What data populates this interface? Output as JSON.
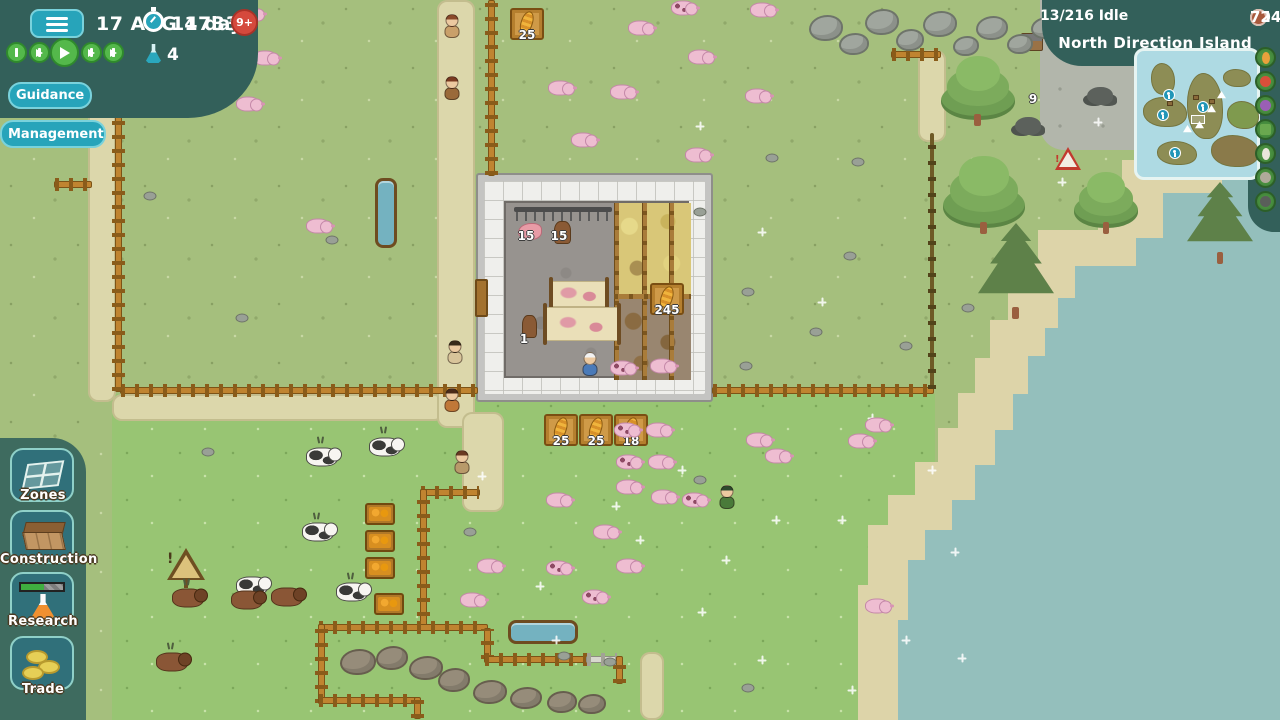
{
  "hud": {
    "date": "17 AUG 1733",
    "timer_label": "14 days",
    "age_badge": "9+",
    "research_points": "4",
    "controls": [
      "pause",
      "slow",
      "play",
      "fast",
      "fastest"
    ],
    "guidance_label": "Guidance",
    "management_label": "Management"
  },
  "topbar_right": {
    "idle_label": "13/216 Idle",
    "resources": [
      {
        "name": "wood",
        "value": "124",
        "color": "#d9b268"
      },
      {
        "name": "stone",
        "value": "80",
        "color": "#c3c8bf"
      },
      {
        "name": "food",
        "value": "95",
        "color": "#58b14c"
      },
      {
        "name": "bricks",
        "value": "72",
        "color": "#a8593c"
      }
    ],
    "location": "North Direction Island"
  },
  "minimap": {
    "islands": [
      {
        "x": 14,
        "y": 12,
        "w": 24,
        "h": 32
      },
      {
        "x": 6,
        "y": 46,
        "w": 44,
        "h": 30
      },
      {
        "x": 50,
        "y": 22,
        "w": 36,
        "h": 66
      },
      {
        "x": 86,
        "y": 18,
        "w": 28,
        "h": 18
      },
      {
        "x": 90,
        "y": 50,
        "w": 32,
        "h": 28,
        "c": "#7f9a4e"
      },
      {
        "x": 20,
        "y": 90,
        "w": 40,
        "h": 24
      },
      {
        "x": 74,
        "y": 84,
        "w": 48,
        "h": 32,
        "c": "#8a7a4a"
      }
    ],
    "anchors": [
      {
        "x": 26,
        "y": 38
      },
      {
        "x": 20,
        "y": 58
      },
      {
        "x": 60,
        "y": 50
      },
      {
        "x": 32,
        "y": 96
      }
    ],
    "ships": [
      {
        "x": 70,
        "y": 54
      },
      {
        "x": 58,
        "y": 70
      },
      {
        "x": 46,
        "y": 74
      },
      {
        "x": 80,
        "y": 40
      }
    ],
    "huts": [
      {
        "x": 30,
        "y": 50
      },
      {
        "x": 72,
        "y": 48
      },
      {
        "x": 56,
        "y": 44
      }
    ],
    "outline_rect": {
      "x": 54,
      "y": 64,
      "w": 14,
      "h": 9
    }
  },
  "map_filters": [
    {
      "name": "corn",
      "color": "#e8a13c"
    },
    {
      "name": "tomato",
      "color": "#d84f3a"
    },
    {
      "name": "grapes",
      "color": "#9a5fb5"
    },
    {
      "name": "crate",
      "color": "#6aa84f"
    },
    {
      "name": "egg",
      "color": "#eae6da"
    },
    {
      "name": "stone",
      "color": "#b0aa9a"
    },
    {
      "name": "coal",
      "color": "#5a5f5a"
    }
  ],
  "sidebar": {
    "items": [
      {
        "id": "zones",
        "label": "Zones"
      },
      {
        "id": "construction",
        "label": "Construction"
      },
      {
        "id": "research",
        "label": "Research"
      },
      {
        "id": "trade",
        "label": "Trade"
      }
    ]
  },
  "world": {
    "colors": {
      "grass": "#a5bf7d",
      "pasture": "#98c573",
      "sand": "#ddd4a9",
      "water": "#94bfbc",
      "path": "#dcd7ab",
      "hudteal": "#33605a",
      "btn_teal": "#27a4ba"
    },
    "items": [
      {
        "t": "path",
        "x": 88,
        "y": 0,
        "w": 28,
        "h": 402
      },
      {
        "t": "path",
        "x": 112,
        "y": 394,
        "w": 332,
        "h": 27
      },
      {
        "t": "path",
        "x": 437,
        "y": 0,
        "w": 38,
        "h": 428
      },
      {
        "t": "path",
        "x": 462,
        "y": 412,
        "w": 42,
        "h": 100
      },
      {
        "t": "path",
        "x": 918,
        "y": 50,
        "w": 28,
        "h": 92
      },
      {
        "t": "path",
        "x": 640,
        "y": 652,
        "w": 24,
        "h": 68
      },
      {
        "t": "fh",
        "x": 120,
        "y": 387,
        "l": 358
      },
      {
        "t": "fh",
        "x": 712,
        "y": 387,
        "l": 222
      },
      {
        "t": "fp",
        "x": 930,
        "y": 133,
        "l": 256
      },
      {
        "t": "fv",
        "x": 115,
        "y": 0,
        "l": 392
      },
      {
        "t": "fv",
        "x": 488,
        "y": 0,
        "l": 176
      },
      {
        "t": "fh",
        "x": 54,
        "y": 181,
        "l": 38
      },
      {
        "t": "fv",
        "x": 179,
        "y": 0,
        "l": 88
      },
      {
        "t": "fh",
        "x": 891,
        "y": 51,
        "l": 50
      },
      {
        "t": "fh",
        "x": 420,
        "y": 489,
        "l": 60
      },
      {
        "t": "fv",
        "x": 420,
        "y": 489,
        "l": 142
      },
      {
        "t": "fh",
        "x": 318,
        "y": 624,
        "l": 170
      },
      {
        "t": "fv",
        "x": 484,
        "y": 628,
        "l": 32
      },
      {
        "t": "fh",
        "x": 484,
        "y": 656,
        "l": 104
      },
      {
        "t": "fhw",
        "x": 586,
        "y": 656,
        "l": 32
      },
      {
        "t": "fv",
        "x": 616,
        "y": 656,
        "l": 28
      },
      {
        "t": "fv",
        "x": 318,
        "y": 624,
        "l": 80
      },
      {
        "t": "fh",
        "x": 318,
        "y": 697,
        "l": 100
      },
      {
        "t": "fv",
        "x": 414,
        "y": 697,
        "l": 22
      },
      {
        "t": "trv",
        "x": 375,
        "y": 178,
        "w": 22,
        "h": 70
      },
      {
        "t": "trh",
        "x": 508,
        "y": 620,
        "w": 70,
        "h": 24
      },
      {
        "t": "crate",
        "x": 527,
        "y": 24,
        "v": "25"
      },
      {
        "t": "crate",
        "x": 561,
        "y": 430,
        "v": "25"
      },
      {
        "t": "crate",
        "x": 596,
        "y": 430,
        "v": "25"
      },
      {
        "t": "crate",
        "x": 631,
        "y": 430,
        "v": "18"
      },
      {
        "t": "crate",
        "x": 667,
        "y": 299,
        "v": "245"
      },
      {
        "t": "amber",
        "x": 380,
        "y": 514
      },
      {
        "t": "amber",
        "x": 380,
        "y": 541
      },
      {
        "t": "amber",
        "x": 380,
        "y": 568
      },
      {
        "t": "amber",
        "x": 389,
        "y": 604
      },
      {
        "t": "signw",
        "x": 186,
        "y": 566
      },
      {
        "t": "signr",
        "x": 1068,
        "y": 160
      },
      {
        "t": "hut",
        "x": 1032,
        "y": 42
      },
      {
        "t": "coal",
        "x": 1028,
        "y": 126
      },
      {
        "t": "coal",
        "x": 1100,
        "y": 96
      },
      {
        "t": "label",
        "x": 1033,
        "y": 99,
        "v": "9"
      },
      {
        "t": "label",
        "x": 526,
        "y": 236,
        "v": "15"
      },
      {
        "t": "label",
        "x": 559,
        "y": 236,
        "v": "15"
      },
      {
        "t": "label",
        "x": 524,
        "y": 339,
        "v": "1"
      },
      {
        "t": "tree",
        "x": 978,
        "y": 88,
        "w": 74,
        "h": 64
      },
      {
        "t": "tree",
        "x": 984,
        "y": 192,
        "w": 82,
        "h": 72
      },
      {
        "t": "pine",
        "x": 1016,
        "y": 268,
        "w": 76,
        "h": 90
      },
      {
        "t": "tree",
        "x": 1106,
        "y": 200,
        "w": 64,
        "h": 56
      },
      {
        "t": "pine",
        "x": 1220,
        "y": 220,
        "w": 66,
        "h": 76
      },
      {
        "t": "tree",
        "x": 1272,
        "y": 200,
        "w": 46,
        "h": 42
      },
      {
        "t": "boulder",
        "x": 826,
        "y": 28,
        "w": 34,
        "h": 26
      },
      {
        "t": "boulder",
        "x": 854,
        "y": 44,
        "w": 30,
        "h": 22
      },
      {
        "t": "boulder",
        "x": 882,
        "y": 22,
        "w": 34,
        "h": 26
      },
      {
        "t": "boulder",
        "x": 910,
        "y": 40,
        "w": 28,
        "h": 22
      },
      {
        "t": "boulder",
        "x": 940,
        "y": 24,
        "w": 34,
        "h": 26
      },
      {
        "t": "boulder",
        "x": 966,
        "y": 46,
        "w": 26,
        "h": 20
      },
      {
        "t": "boulder",
        "x": 992,
        "y": 28,
        "w": 32,
        "h": 24
      },
      {
        "t": "boulder",
        "x": 1020,
        "y": 44,
        "w": 26,
        "h": 20
      },
      {
        "t": "boulder",
        "x": 1046,
        "y": 28,
        "w": 30,
        "h": 22
      },
      {
        "t": "boulder",
        "x": 358,
        "y": 662,
        "w": 36,
        "h": 26,
        "c": "b"
      },
      {
        "t": "boulder",
        "x": 392,
        "y": 658,
        "w": 32,
        "h": 24,
        "c": "b"
      },
      {
        "t": "boulder",
        "x": 426,
        "y": 668,
        "w": 34,
        "h": 24,
        "c": "b"
      },
      {
        "t": "boulder",
        "x": 454,
        "y": 680,
        "w": 32,
        "h": 24,
        "c": "b"
      },
      {
        "t": "boulder",
        "x": 490,
        "y": 692,
        "w": 34,
        "h": 24,
        "c": "b"
      },
      {
        "t": "boulder",
        "x": 526,
        "y": 698,
        "w": 32,
        "h": 22,
        "c": "b"
      },
      {
        "t": "boulder",
        "x": 562,
        "y": 702,
        "w": 30,
        "h": 22,
        "c": "b"
      },
      {
        "t": "boulder",
        "x": 592,
        "y": 704,
        "w": 28,
        "h": 20,
        "c": "b"
      },
      {
        "t": "rock",
        "x": 150,
        "y": 196
      },
      {
        "t": "rock",
        "x": 242,
        "y": 318
      },
      {
        "t": "rock",
        "x": 332,
        "y": 240
      },
      {
        "t": "rock",
        "x": 772,
        "y": 158
      },
      {
        "t": "rock",
        "x": 858,
        "y": 162
      },
      {
        "t": "rock",
        "x": 700,
        "y": 212
      },
      {
        "t": "rock",
        "x": 748,
        "y": 292
      },
      {
        "t": "rock",
        "x": 816,
        "y": 332
      },
      {
        "t": "rock",
        "x": 906,
        "y": 346
      },
      {
        "t": "rock",
        "x": 968,
        "y": 308
      },
      {
        "t": "rock",
        "x": 850,
        "y": 256
      },
      {
        "t": "rock",
        "x": 746,
        "y": 366
      },
      {
        "t": "rock",
        "x": 564,
        "y": 656
      },
      {
        "t": "rock",
        "x": 610,
        "y": 662
      },
      {
        "t": "rock",
        "x": 470,
        "y": 532
      },
      {
        "t": "rock",
        "x": 748,
        "y": 688
      },
      {
        "t": "rock",
        "x": 700,
        "y": 480
      },
      {
        "t": "rock",
        "x": 208,
        "y": 452
      },
      {
        "t": "sparkle",
        "x": 700,
        "y": 126
      },
      {
        "t": "sparkle",
        "x": 762,
        "y": 232
      },
      {
        "t": "sparkle",
        "x": 822,
        "y": 302
      },
      {
        "t": "sparkle",
        "x": 872,
        "y": 418
      },
      {
        "t": "sparkle",
        "x": 640,
        "y": 540
      },
      {
        "t": "sparkle",
        "x": 702,
        "y": 612
      },
      {
        "t": "sparkle",
        "x": 556,
        "y": 640
      },
      {
        "t": "sparkle",
        "x": 762,
        "y": 660
      },
      {
        "t": "sparkle",
        "x": 852,
        "y": 690
      },
      {
        "t": "sparkle",
        "x": 932,
        "y": 470
      },
      {
        "t": "sparkle",
        "x": 955,
        "y": 552
      },
      {
        "t": "sparkle",
        "x": 482,
        "y": 476
      },
      {
        "t": "sparkle",
        "x": 540,
        "y": 586
      },
      {
        "t": "sparkle",
        "x": 616,
        "y": 506
      },
      {
        "t": "sparkle",
        "x": 682,
        "y": 470
      },
      {
        "t": "sparkle",
        "x": 776,
        "y": 520
      },
      {
        "t": "sparkle",
        "x": 726,
        "y": 560
      },
      {
        "t": "sparkle",
        "x": 906,
        "y": 640
      },
      {
        "t": "sparkle",
        "x": 842,
        "y": 520
      },
      {
        "t": "sparkle",
        "x": 962,
        "y": 658
      },
      {
        "t": "sparkle",
        "x": 1062,
        "y": 182
      },
      {
        "t": "sparkle",
        "x": 1098,
        "y": 122
      },
      {
        "t": "tuft",
        "x": 320,
        "y": 440
      },
      {
        "t": "tuft",
        "x": 383,
        "y": 430
      },
      {
        "t": "tuft",
        "x": 316,
        "y": 516
      },
      {
        "t": "tuft",
        "x": 186,
        "y": 582
      },
      {
        "t": "tuft",
        "x": 246,
        "y": 584
      },
      {
        "t": "tuft",
        "x": 350,
        "y": 576
      },
      {
        "t": "tuft",
        "x": 170,
        "y": 646
      },
      {
        "t": "cow",
        "x": 322,
        "y": 457
      },
      {
        "t": "cow",
        "x": 385,
        "y": 447
      },
      {
        "t": "cow",
        "x": 318,
        "y": 532
      },
      {
        "t": "cow",
        "x": 252,
        "y": 586
      },
      {
        "t": "cow",
        "x": 352,
        "y": 592
      },
      {
        "t": "bull",
        "x": 188,
        "y": 598
      },
      {
        "t": "bull",
        "x": 247,
        "y": 600
      },
      {
        "t": "bull",
        "x": 287,
        "y": 597
      },
      {
        "t": "bull",
        "x": 172,
        "y": 662
      },
      {
        "t": "pig",
        "x": 250,
        "y": 14
      },
      {
        "t": "pig",
        "x": 265,
        "y": 58
      },
      {
        "t": "pig",
        "x": 248,
        "y": 104
      },
      {
        "t": "pig",
        "x": 318,
        "y": 226
      },
      {
        "t": "pig",
        "x": 560,
        "y": 88
      },
      {
        "t": "pig",
        "x": 622,
        "y": 92
      },
      {
        "t": "pig",
        "x": 583,
        "y": 140
      },
      {
        "t": "pig",
        "x": 697,
        "y": 155
      },
      {
        "t": "pig",
        "x": 700,
        "y": 57
      },
      {
        "t": "pig",
        "x": 757,
        "y": 96
      },
      {
        "t": "pig",
        "x": 762,
        "y": 10
      },
      {
        "t": "pig",
        "x": 640,
        "y": 28
      },
      {
        "t": "pig",
        "x": 658,
        "y": 430
      },
      {
        "t": "pig",
        "x": 660,
        "y": 462
      },
      {
        "t": "pig",
        "x": 628,
        "y": 487
      },
      {
        "t": "pig",
        "x": 663,
        "y": 497
      },
      {
        "t": "pig",
        "x": 558,
        "y": 500
      },
      {
        "t": "pig",
        "x": 605,
        "y": 532
      },
      {
        "t": "pig",
        "x": 489,
        "y": 566
      },
      {
        "t": "pig",
        "x": 628,
        "y": 566
      },
      {
        "t": "pig",
        "x": 472,
        "y": 600
      },
      {
        "t": "pig",
        "x": 877,
        "y": 606
      },
      {
        "t": "pig",
        "x": 758,
        "y": 440
      },
      {
        "t": "pig",
        "x": 777,
        "y": 456
      },
      {
        "t": "pig",
        "x": 860,
        "y": 441
      },
      {
        "t": "pig",
        "x": 877,
        "y": 425
      },
      {
        "t": "pig",
        "x": 662,
        "y": 366
      },
      {
        "t": "pigspot",
        "x": 683,
        "y": 8
      },
      {
        "t": "pigspot",
        "x": 626,
        "y": 430
      },
      {
        "t": "pigspot",
        "x": 628,
        "y": 462
      },
      {
        "t": "pigspot",
        "x": 694,
        "y": 500
      },
      {
        "t": "pigspot",
        "x": 558,
        "y": 568
      },
      {
        "t": "pigspot",
        "x": 594,
        "y": 597
      },
      {
        "t": "pigspot",
        "x": 622,
        "y": 368
      },
      {
        "t": "vil",
        "x": 452,
        "y": 26,
        "hair": "#8a4a2a",
        "shirt": "#c9a06a"
      },
      {
        "t": "vil",
        "x": 452,
        "y": 88,
        "hair": "#7a3a20",
        "shirt": "#9a6a3a"
      },
      {
        "t": "vil",
        "x": 455,
        "y": 352,
        "hair": "#3a2a1a",
        "shirt": "#d8c49a"
      },
      {
        "t": "vil",
        "x": 452,
        "y": 400,
        "hair": "#4a2a18",
        "shirt": "#c07838"
      },
      {
        "t": "vil",
        "x": 590,
        "y": 364,
        "hair": "#f2f2f2",
        "shirt": "#4a7ab8"
      },
      {
        "t": "vil",
        "x": 462,
        "y": 462,
        "hair": "#6a3a22",
        "shirt": "#b89a6a"
      },
      {
        "t": "vil",
        "x": 727,
        "y": 497,
        "hair": "#2e4a2e",
        "shirt": "#4a7a3a"
      }
    ]
  }
}
